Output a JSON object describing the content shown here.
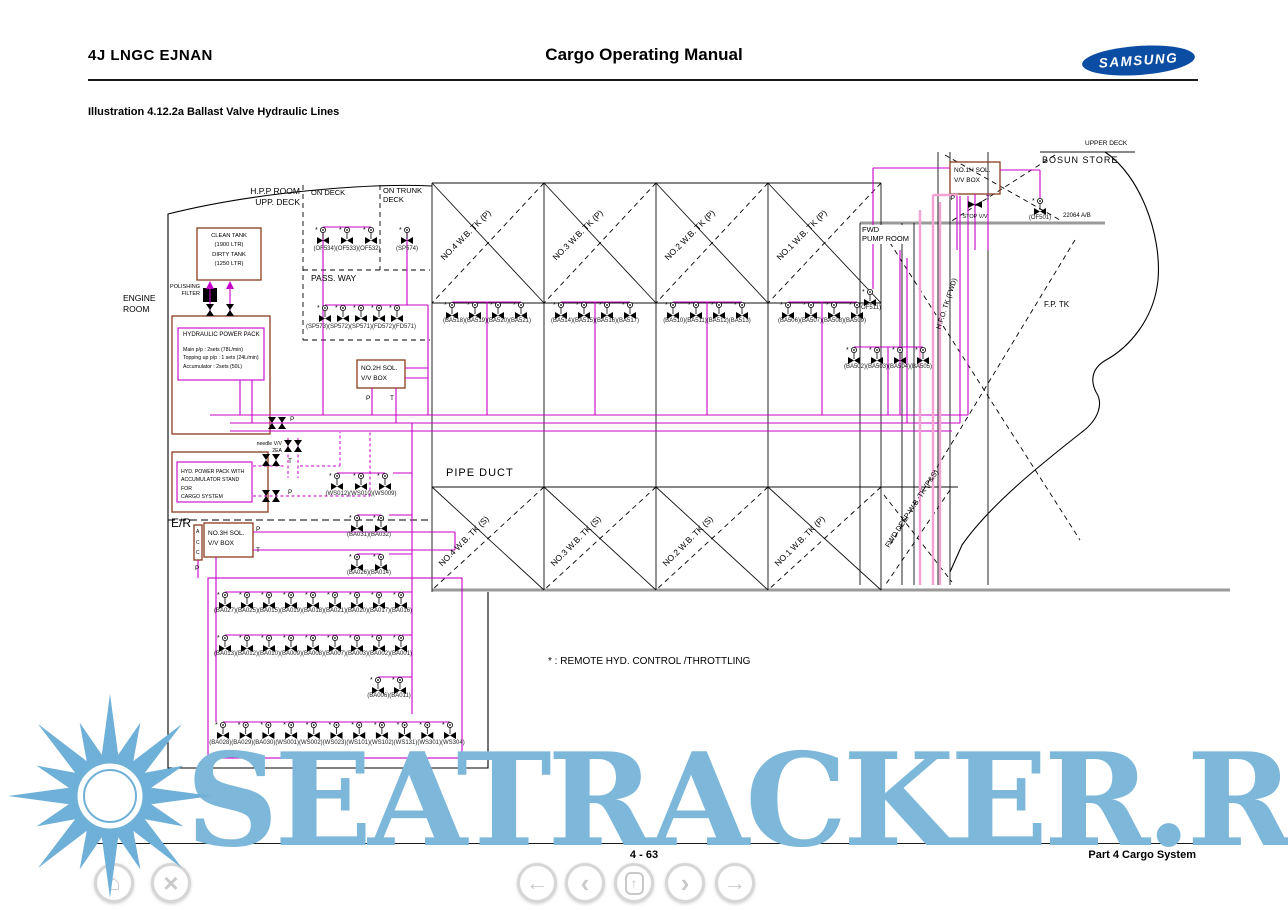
{
  "header": {
    "ship_name": "4J LNGC EJNAN",
    "manual_title": "Cargo Operating Manual",
    "brand": "SAMSUNG"
  },
  "illustration_title": "Illustration 4.12.2a Ballast Valve Hydraulic Lines",
  "footer": {
    "page": "4 - 63",
    "section": "Part 4 Cargo System"
  },
  "watermark": "SEATRACKER.RU",
  "diagram": {
    "areas": {
      "hpp_room": "H.P.P ROOM\nUPP. DECK",
      "on_deck": "ON DECK",
      "on_trunk_deck": "ON TRUNK\nDECK",
      "pass_way": "PASS. WAY",
      "engine_room": "ENGINE\nROOM",
      "er": "E/R",
      "pipe_duct": "PIPE DUCT",
      "fwd_pump_room": "FWD\nPUMP ROOM",
      "bosun_store": "BOSUN STORE",
      "upper_deck": "UPPER DECK",
      "fp_tk": "F.P. TK",
      "hfo_tk": "H.F.O. TK (FWD)",
      "fwd_deep_tk": "FWD DEEP W.B. TK (P&S)",
      "doc_ref": "22064 A/B"
    },
    "tanks_top": [
      "NO.4 W.B. TK (P)",
      "NO.3 W.B. TK (P)",
      "NO.2 W.B. TK (P)",
      "NO.1 W.B. TK (P)"
    ],
    "tanks_bottom": [
      "NO.4 W.B. TK (S)",
      "NO.3 W.B. TK (S)",
      "NO.2 W.B. TK (S)",
      "NO.1 W.B. TK (P)"
    ],
    "equipment": {
      "tank_box": "CLEAN TANK\n(1900 LTR)\nDIRTY TANK\n(1250 LTR)",
      "polishing_filter": "POLISHING\nFILTER",
      "hpp_title": "HYDRAULIC POWER PACK",
      "hpp_specs": "Main p/p : 2sets (78L/min)\nTopping up p/p : 1 sets (24L/min)\nAccumulator : 2sets (50L)",
      "hyd_pack_cargo": "HYD. POWER PACK WITH\nACCUMULATOR STAND FOR\nCARGO SYSTEM",
      "needle_vv": "needle V/V\n2EA",
      "acc": "A\nC\nC",
      "sol_box_1": "NO.1H SOL.\nV/V BOX",
      "sol_box_2": "NO.2H SOL.\nV/V BOX",
      "sol_box_3": "NO.3H SOL.\nV/V BOX",
      "stop_vv": "STOP V/V",
      "p": "P",
      "t": "T"
    },
    "note": "* : REMOTE HYD. CONTROL /THROTTLING",
    "valve_groups": {
      "of_deck": "(OF534)(OF533)(OF532)",
      "sp574": "(SP574)",
      "passway": "(SP573)(SP572)(SP571)(FD572)(FD571)",
      "ba518": "(BA518)(BA519)(BA520)(BA521)",
      "ba514": "(BA514)(BA515)(BA516)(BA517)",
      "ba510": "(BA510)(BA511)(BA512)(BA513)",
      "ba506": "(BA506)(BA507)(BA508)(BA509)",
      "ba502": "(BA502)(BA503)(BA504)(BA505)",
      "ws012": "(WS012)(WS010)(WS009)",
      "ba031": "(BA031)(BA032)",
      "ba026": "(BA026)(BA014)",
      "row_a": "(BA027)(BA025)(BA015)(BA019)(BA018)(BA021)(BA020)(BA017)(BA016)",
      "row_b": "(BA013)(BA012)(BA010)(BA009)(BA008)(BA007)(BA003)(BA002)(BA001)",
      "ba006": "(BA006)(BA011)",
      "row_c": "(BA028)(BA029)(BA030)(WS001)(WS002)(WS023)(WS101)(WS102)(WS131)(WS301)(WS304)",
      "of511": "(OF511)",
      "of501": "(OF501)"
    },
    "colors": {
      "line": "#c800c8",
      "line_light": "#f2a3d2",
      "box": "#8a3c1e",
      "watermark": "#7db7da"
    }
  },
  "nav": {
    "home": "⌂",
    "close": "×",
    "back": "←",
    "prev": "‹",
    "up": "↑",
    "next": "›",
    "forward": "→"
  }
}
